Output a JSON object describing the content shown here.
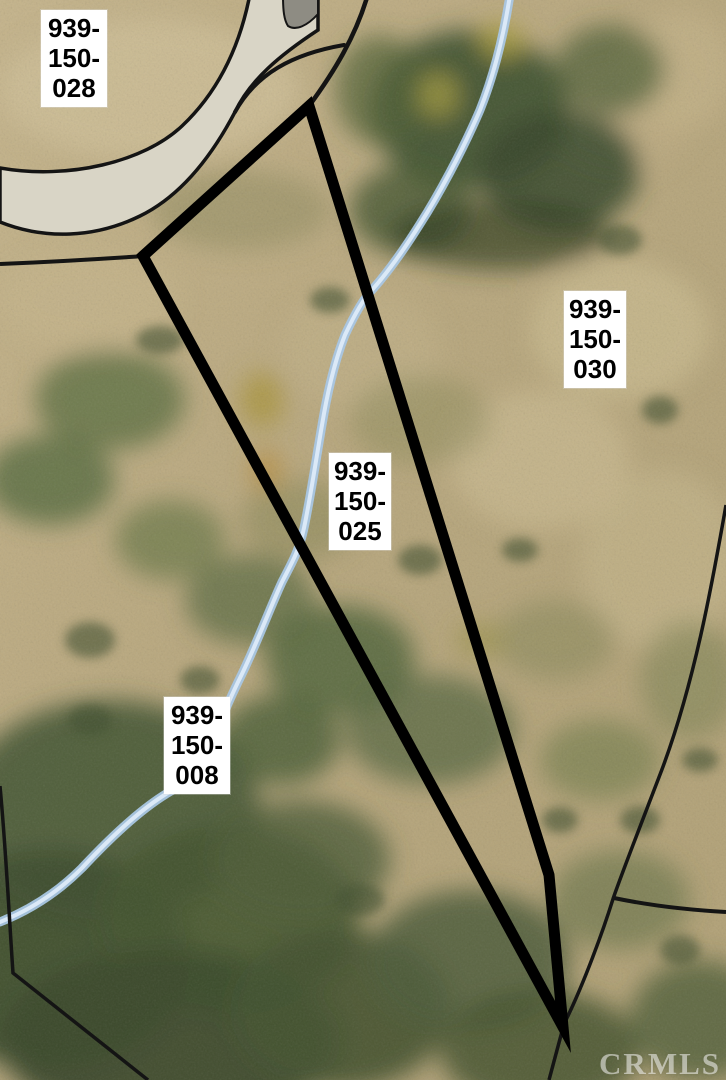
{
  "page": {
    "type": "listing-photo",
    "content": "aerial parcel map"
  },
  "map": {
    "watermark": "CRMLS",
    "subject_apn": "939-150-025",
    "parcels": [
      {
        "apn": "939-150-028",
        "lines": [
          "939-",
          "150-",
          "028"
        ],
        "outlined": false,
        "position": "top-left"
      },
      {
        "apn": "939-150-030",
        "lines": [
          "939-",
          "150-",
          "030"
        ],
        "outlined": false,
        "position": "right"
      },
      {
        "apn": "939-150-025",
        "lines": [
          "939-",
          "150-",
          "025"
        ],
        "outlined": true,
        "position": "center"
      },
      {
        "apn": "939-150-008",
        "lines": [
          "939-",
          "150-",
          "008"
        ],
        "outlined": false,
        "position": "bottom-left"
      }
    ],
    "features": [
      {
        "name": "road",
        "description": "paved road curving through upper-left corner"
      },
      {
        "name": "creek",
        "description": "pale blue drainage line running from top center to lower left"
      },
      {
        "name": "subject-boundary",
        "description": "bold black triangular lot outline"
      }
    ],
    "colors": {
      "boundary": "#000000",
      "label_bg": "#ffffff",
      "label_text": "#000000",
      "creek": "#cfe2f4",
      "road_pavement": "#d9d5c6",
      "terrain_tan": "#bba97e",
      "terrain_green": "#4a5a35",
      "watermark": "#ffffff"
    }
  }
}
